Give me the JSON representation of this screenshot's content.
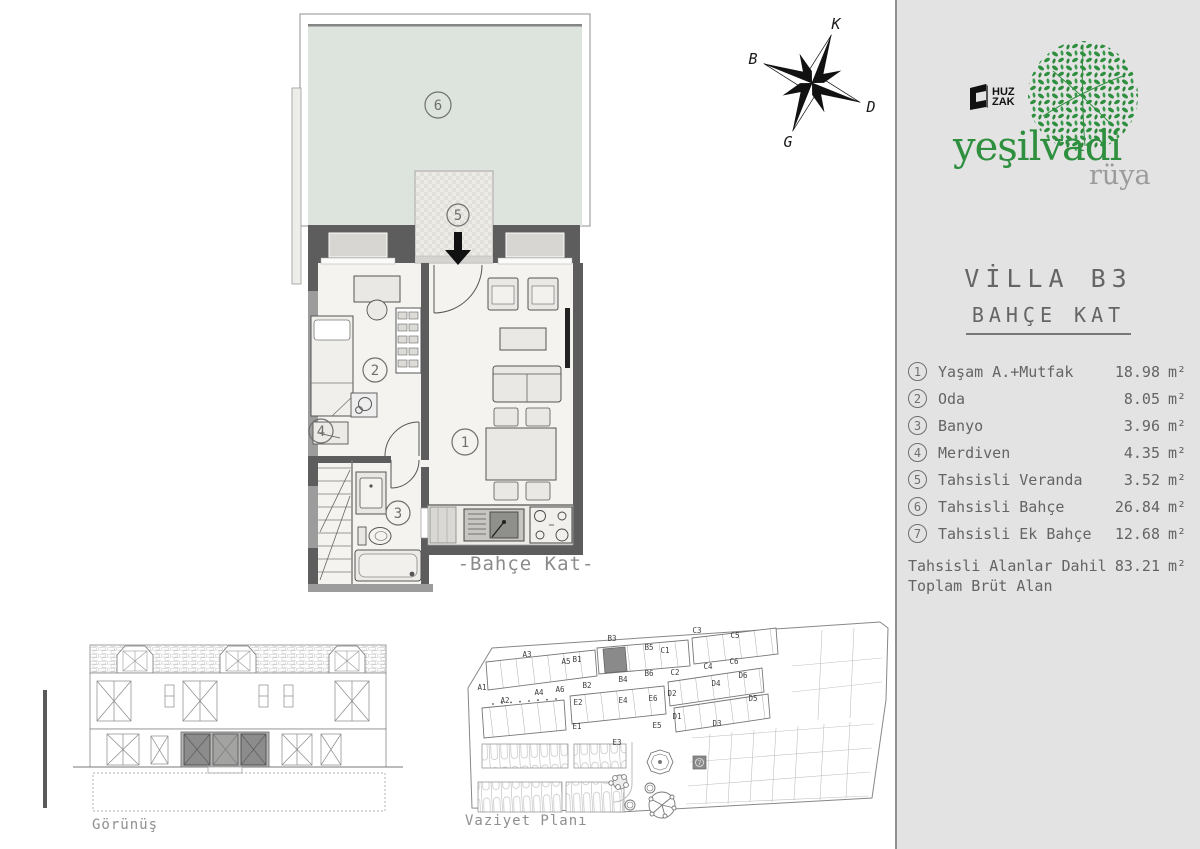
{
  "brand": {
    "huz": "HUZ",
    "zak": "ZAK",
    "name": "yeşilvadi",
    "sub": "rüya",
    "green": "#2e8f3e",
    "gray": "#9b9b9b"
  },
  "sidebar": {
    "title": "VİLLA B3",
    "subtitle": "BAHÇE KAT",
    "unit": "m²",
    "rooms": [
      {
        "num": "1",
        "name": "Yaşam A.+Mutfak",
        "area": "18.98"
      },
      {
        "num": "2",
        "name": "Oda",
        "area": "8.05"
      },
      {
        "num": "3",
        "name": "Banyo",
        "area": "3.96"
      },
      {
        "num": "4",
        "name": "Merdiven",
        "area": "4.35"
      },
      {
        "num": "5",
        "name": "Tahsisli Veranda",
        "area": "3.52"
      },
      {
        "num": "6",
        "name": "Tahsisli Bahçe",
        "area": "26.84"
      },
      {
        "num": "7",
        "name": "Tahsisli Ek Bahçe",
        "area": "12.68"
      }
    ],
    "total": {
      "line1": "Tahsisli Alanlar Dahil",
      "line2": "Toplam Brüt Alan",
      "area": "83.21"
    }
  },
  "floorplan": {
    "label": "-Bahçe Kat-"
  },
  "compass": {
    "n": "K",
    "e": "D",
    "s": "G",
    "w": "B"
  },
  "elevation": {
    "label": "Görünüş"
  },
  "siteplan": {
    "label": "Vaziyet Planı",
    "highlighted": "B3",
    "blocks": [
      "A1",
      "A2",
      "A3",
      "A4",
      "A5",
      "A6",
      "B1",
      "B2",
      "B3",
      "B4",
      "B5",
      "B6",
      "C1",
      "C2",
      "C3",
      "C4",
      "C5",
      "C6",
      "D1",
      "D2",
      "D3",
      "D4",
      "D5",
      "D6",
      "E1",
      "E2",
      "E3",
      "E4",
      "E5",
      "E6"
    ]
  }
}
